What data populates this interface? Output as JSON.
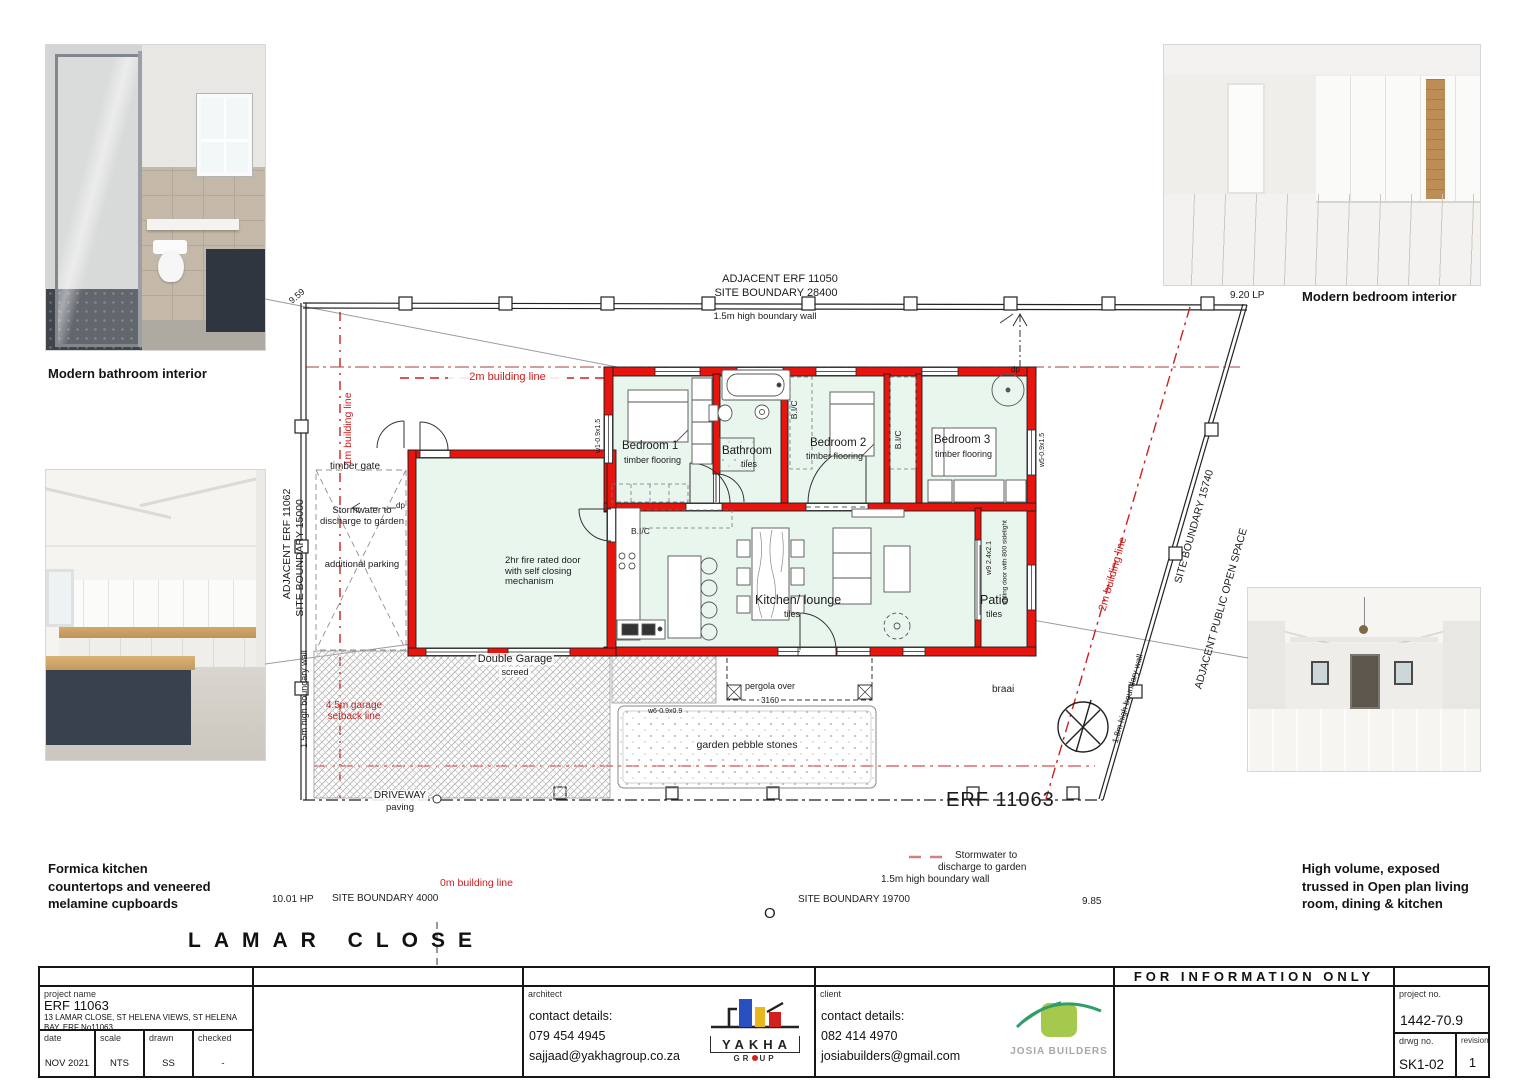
{
  "captions": {
    "bathroom": "Modern bathroom interior",
    "bedroom": "Modern bedroom interior",
    "kitchen_l1": "Formica kitchen",
    "kitchen_l2": "countertops and veneered",
    "kitchen_l3": "melamine cupboards",
    "living_l1": "High volume, exposed",
    "living_l2": "trussed in Open plan living",
    "living_l3": "room, dining & kitchen"
  },
  "site": {
    "adjacent_top": "ADJACENT ERF 11050",
    "boundary_top": "SITE BOUNDARY 28400",
    "wall_top": "1.5m high boundary wall",
    "dim_tl": "9.59",
    "dim_tr": "9.20 LP",
    "adjacent_left": "ADJACENT ERF 11062",
    "boundary_left": "SITE BOUNDARY 15000",
    "wall_left": "1.5m high boundary wall",
    "boundary_right": "SITE BOUNDARY 15740",
    "adjacent_right": "ADJACENT PUBLIC OPEN SPACE",
    "wall_right": "1.8m high boundary wall",
    "dim_bl": "10.01 HP",
    "boundary_bottom_left": "SITE BOUNDARY 4000",
    "boundary_bottom_right": "SITE BOUNDARY 19700",
    "dim_br": "9.85",
    "wall_bottom": "1.5m high boundary wall",
    "storm_b_l1": "Stormwater to",
    "storm_b_l2": "discharge to garden",
    "erf": "ERF 11063",
    "road": "LAMAR CLOSE",
    "manhole": "O"
  },
  "lines": {
    "two_m": "2m building line",
    "one_m": "1m building line",
    "zero_m": "0m building line",
    "two_m_right": "2m building line",
    "setback_l1": "4.5m garage",
    "setback_l2": "setback line"
  },
  "rooms": {
    "bedroom1": "Bedroom 1",
    "bedroom1_floor": "timber flooring",
    "bathroom": "Bathroom",
    "bathroom_floor": "tiles",
    "bedroom2": "Bedroom 2",
    "bedroom2_floor": "timber flooring",
    "bedroom3": "Bedroom 3",
    "bedroom3_floor": "timber flooring",
    "kitchen": "Kitchen/ lounge",
    "kitchen_floor": "tiles",
    "patio": "Patio",
    "patio_floor": "tiles",
    "bic": "B.I/C",
    "garage_name": "Double Garage",
    "garage_floor": "screed",
    "fire_l1": "2hr fire rated door",
    "fire_l2": "with self closing",
    "fire_l3": "mechanism"
  },
  "yard": {
    "timber_gate": "timber gate",
    "storm_l1": "Stormwater to",
    "storm_l2": "discharge to garden",
    "parking": "additional parking",
    "dp": "dp",
    "driveway": "DRIVEWAY",
    "paving": "paving",
    "garden": "garden pebble stones",
    "pergola": "pergola over",
    "pergola_dim": "3160",
    "braai": "braai",
    "w1": "w1-0.9x1.5",
    "w5": "w5-0.9x1.5",
    "w6": "w6-0.9x0.9",
    "w9": "w9 2.4x2.1",
    "sliding": "sliding door with 800 sidelight"
  },
  "titleblock": {
    "project_name_label": "project name",
    "project_name": "ERF 11063",
    "project_address": "13 LAMAR CLOSE, ST HELENA VIEWS, ST HELENA BAY, ERF No11063",
    "date_label": "date",
    "date": "NOV 2021",
    "scale_label": "scale",
    "scale": "NTS",
    "drawn_label": "drawn",
    "drawn": "SS",
    "checked_label": "checked",
    "checked": "-",
    "architect_label": "architect",
    "architect_contact": "contact details:",
    "architect_phone": "079 454 4945",
    "architect_email": "sajjaad@yakhagroup.co.za",
    "client_label": "client",
    "client_contact": "contact details:",
    "client_phone": "082 414 4970",
    "client_email": "josiabuilders@gmail.com",
    "for_information": "FOR INFORMATION ONLY",
    "project_no_label": "project no.",
    "project_no": "1442-70.9",
    "drwg_no_label": "drwg no.",
    "drwg_no": "SK1-02",
    "revision_label": "revision",
    "revision": "1"
  },
  "logos": {
    "yakha": "YAKHA",
    "group_left": "GR",
    "group_right": "UP",
    "josia": "JOSIA BUILDERS"
  },
  "colors": {
    "wall_red": "#e8140e",
    "building_line_red": "#c92121",
    "floor_green": "#e9f6ee"
  }
}
